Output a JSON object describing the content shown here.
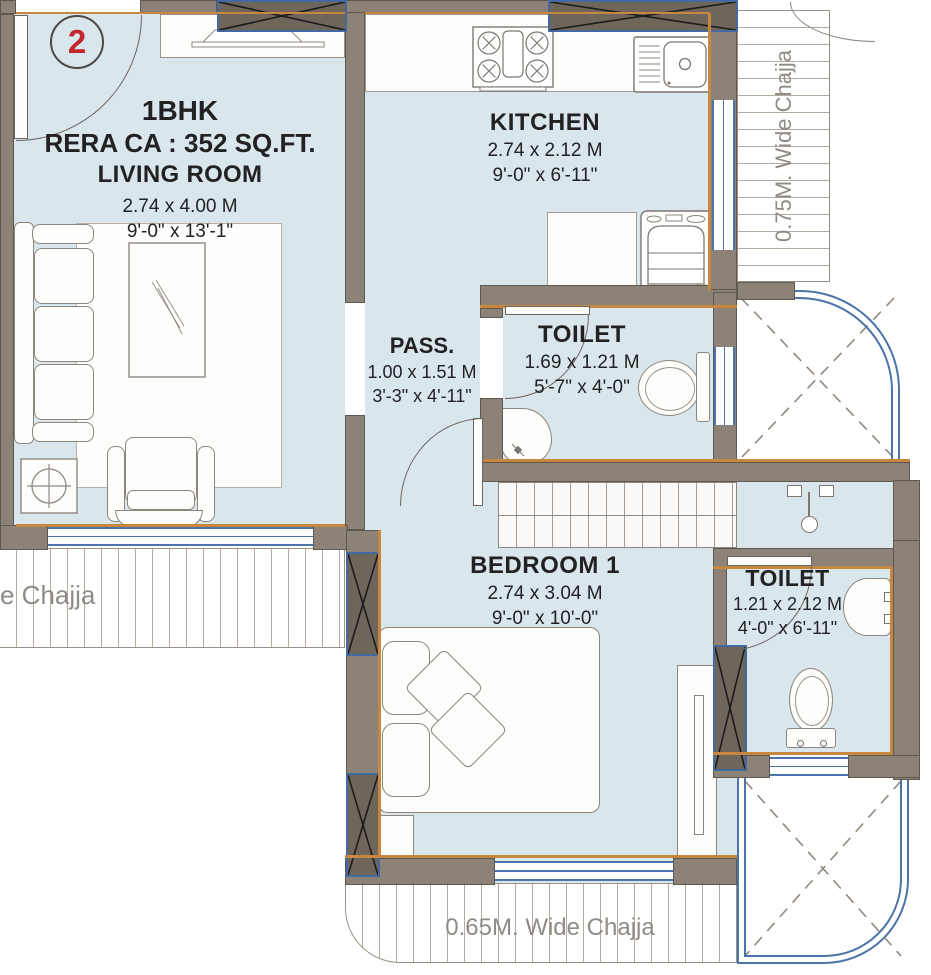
{
  "unit": {
    "number": "2"
  },
  "rooms": {
    "living": {
      "type": "1BHK",
      "rera": "RERA CA : 352 SQ.FT.",
      "name": "LIVING ROOM",
      "dim_m": "2.74 x 4.00 M",
      "dim_ft": "9'-0\" x 13'-1\""
    },
    "kitchen": {
      "name": "KITCHEN",
      "dim_m": "2.74 x 2.12 M",
      "dim_ft": "9'-0\" x 6'-11\""
    },
    "passage": {
      "name": "PASS.",
      "dim_m": "1.00 x 1.51 M",
      "dim_ft": "3'-3\" x 4'-11\""
    },
    "toilet1": {
      "name": "TOILET",
      "dim_m": "1.69 x 1.21 M",
      "dim_ft": "5'-7\" x 4'-0\""
    },
    "bedroom": {
      "name": "BEDROOM 1",
      "dim_m": "2.74 x 3.04 M",
      "dim_ft": "9'-0\" x 10'-0\""
    },
    "toilet2": {
      "name": "TOILET",
      "dim_m": "1.21 x 2.12 M",
      "dim_ft": "4'-0\" x 6'-11\""
    }
  },
  "chajjas": {
    "right": {
      "label": "0.75M. Wide Chajja"
    },
    "left": {
      "label": "e Chajja"
    },
    "bottom": {
      "label": "0.65M. Wide Chajja"
    }
  },
  "colors": {
    "floor": "#d9e6ec",
    "wall": "#8c8277",
    "column": "#6e665a",
    "window_blue": "#4b74ab",
    "accent_orange": "#c8873f",
    "unit_red": "#c1272c",
    "chajja_text": "#8f8b85"
  }
}
